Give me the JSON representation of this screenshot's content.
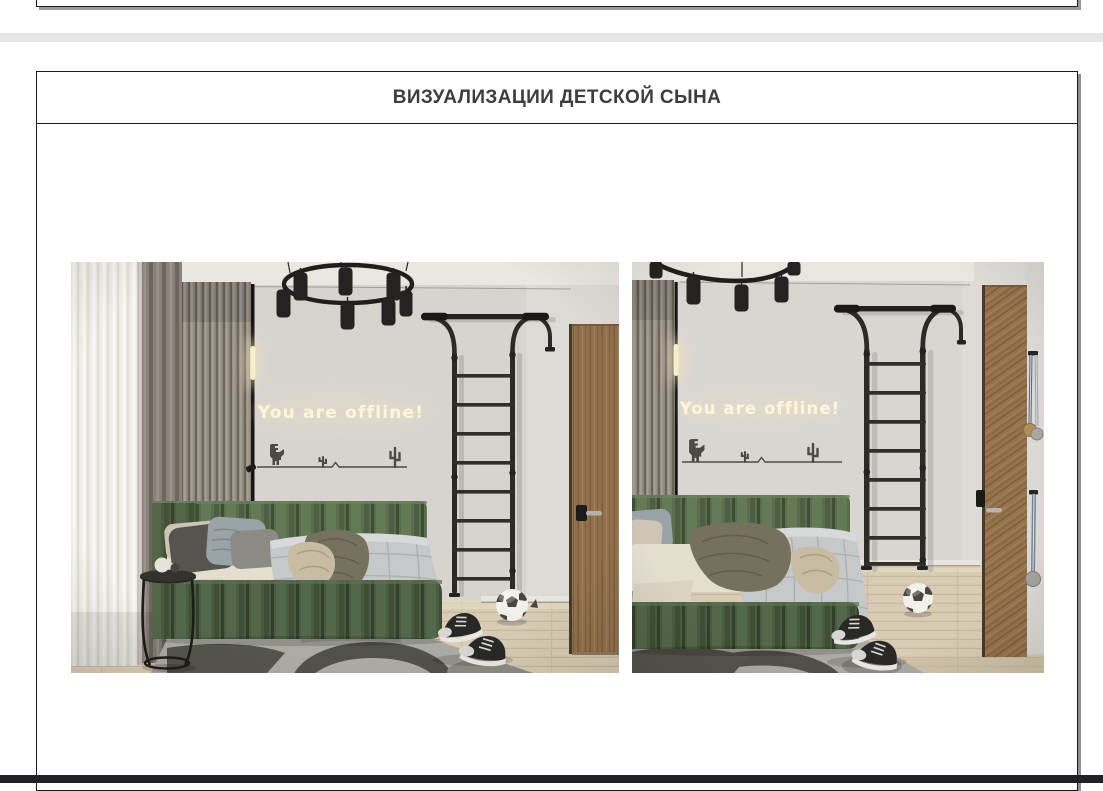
{
  "header": {
    "title": "ВИЗУАЛИЗАЦИИ ДЕТСКОЙ СЫНА"
  },
  "renders": {
    "left": {
      "name": "kids-room-render-view-1",
      "neon_text": "You are offline!"
    },
    "right": {
      "name": "kids-room-render-view-2",
      "neon_text": "You are offline!"
    }
  },
  "palette": {
    "page_gap": "#e6e6e6",
    "frame_border": "#1b1b1b",
    "frame_shadow": "#8f8f8f",
    "bottom_bar": "#1f2124",
    "wall": "#d8d5d1",
    "bed_green": "#57694b",
    "bed_green_dark": "#47593d",
    "neon_glow": "#f8f1dd",
    "black_metal": "#242321",
    "floor_wood": "#d8cbb3",
    "door_wood": "#9b7950",
    "rug": "#acaaa5",
    "rug_pattern": "#53504b"
  }
}
